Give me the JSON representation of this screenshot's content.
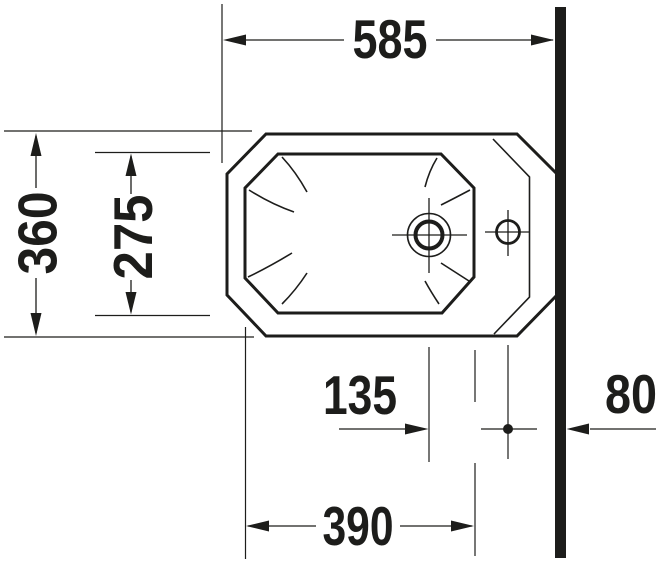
{
  "drawing": {
    "ink_color": "#1d1d1b",
    "background_color": "#ffffff",
    "dimensions": {
      "overall_depth": "585",
      "overall_width": "360",
      "basin_width": "275",
      "drain_to_taphole": "135",
      "front_to_drain": "390",
      "taphole_to_wall": "80"
    }
  }
}
